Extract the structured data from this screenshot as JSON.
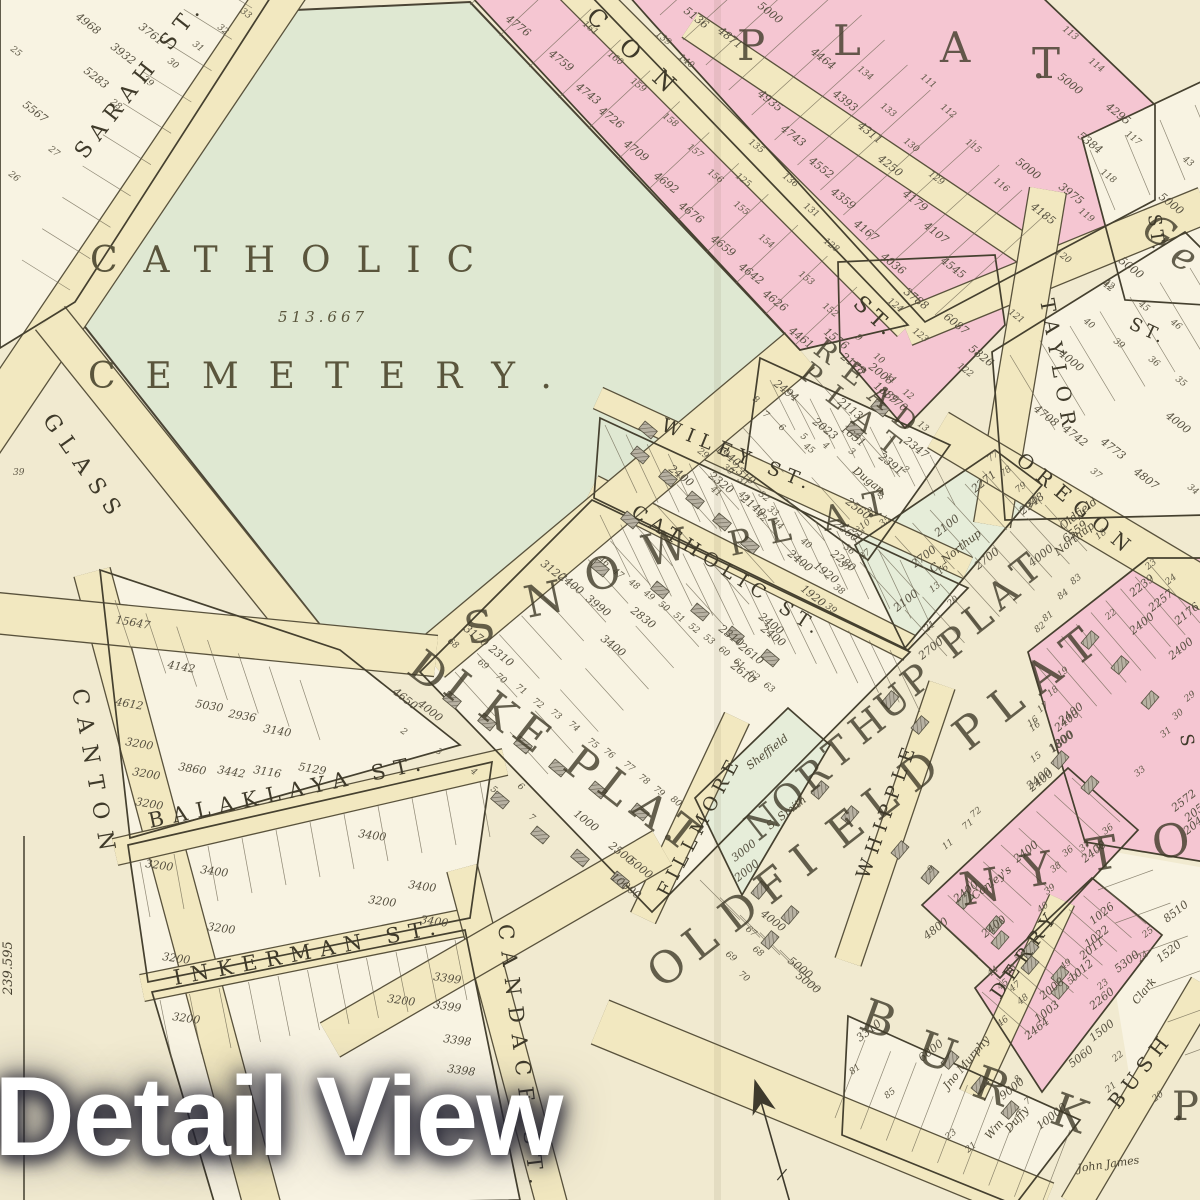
{
  "watermark": {
    "text": "Detail View"
  },
  "cemetery": {
    "name_line1": "CATHOLIC",
    "name_line2": "CEMETERY.",
    "area": "513.667"
  },
  "margin": {
    "left_number": "239.595"
  },
  "palette": {
    "paper": "#f1ead0",
    "lot_white": "#f8f3e2",
    "road": "#f2e8c0",
    "pink": "#f5c6d2",
    "green_cemetery": "#dfe8d2",
    "green_tint": "#e6edd9",
    "line": "#45402f",
    "text": "#4a4433",
    "watermark_text": "#ffffff"
  },
  "icons": [
    {
      "id": "north-arrow-icon",
      "meaning": "compass north arrow"
    }
  ],
  "streets": [
    {
      "id": "sarah",
      "label": "SARAH ST."
    },
    {
      "id": "glass",
      "label": "GLASS"
    },
    {
      "id": "canton",
      "label": "CANTON"
    },
    {
      "id": "balaklaya",
      "label": "BALAKLAYA ST."
    },
    {
      "id": "inkerman",
      "label": "INKERMAN ST."
    },
    {
      "id": "candace",
      "label": "CANDACE ST."
    },
    {
      "id": "wiley",
      "label": "WILEY ST."
    },
    {
      "id": "catholic",
      "label": "CATHOLIC ST."
    },
    {
      "id": "fillmore",
      "label": "FILLMORE"
    },
    {
      "id": "whipple",
      "label": "WHIPPLE"
    },
    {
      "id": "derry",
      "label": "DERRY"
    },
    {
      "id": "bush",
      "label": "BUSH"
    },
    {
      "id": "taylor",
      "label": "TAYLOR"
    },
    {
      "id": "taylor-st",
      "label": "ST."
    },
    {
      "id": "oregon",
      "label": "OREGON"
    },
    {
      "id": "con",
      "label": "CON"
    },
    {
      "id": "con-st",
      "label": "ST."
    },
    {
      "id": "right-edge-st",
      "label": "ST."
    },
    {
      "id": "right-edge-s",
      "label": "S"
    }
  ],
  "plats": [
    {
      "id": "plat-top",
      "label": "PLAT."
    },
    {
      "id": "read",
      "label": "READ"
    },
    {
      "id": "read-plat",
      "label": "PLAT"
    },
    {
      "id": "snow",
      "label": "SNOW"
    },
    {
      "id": "snow-plat",
      "label": "PLAT."
    },
    {
      "id": "dike",
      "label": "DIKE"
    },
    {
      "id": "dike-plat",
      "label": "PLAT."
    },
    {
      "id": "northup",
      "label": "NORTHUP PLAT"
    },
    {
      "id": "oldfield",
      "label": "OLDFIELD PLAT"
    },
    {
      "id": "letter-n",
      "label": "N"
    },
    {
      "id": "letter-y",
      "label": "Y"
    },
    {
      "id": "letter-t",
      "label": "T"
    },
    {
      "id": "letter-o",
      "label": "O"
    },
    {
      "id": "burk",
      "label": "BURK"
    },
    {
      "id": "ge",
      "label": "Ge"
    },
    {
      "id": "big-p",
      "label": "P."
    }
  ],
  "owners": [
    {
      "id": "dugan",
      "name": "Dugan"
    },
    {
      "id": "sheffield",
      "name": "Sheffield"
    },
    {
      "id": "s-smith",
      "name": "S. Smith"
    },
    {
      "id": "oldfield-owner",
      "name": "Oldfield"
    },
    {
      "id": "oldfield-no",
      "name": "6559"
    },
    {
      "id": "northup-owner",
      "name": "Northup"
    },
    {
      "id": "c-northup",
      "name": "C. Northup"
    },
    {
      "id": "conleys",
      "name": "Conley's"
    },
    {
      "id": "clark",
      "name": "Clark"
    },
    {
      "id": "jno-murphy",
      "name": "Jno Murphy"
    },
    {
      "id": "wm",
      "name": "Wm"
    },
    {
      "id": "duffy",
      "name": "Duffy"
    },
    {
      "id": "john-james",
      "name": "John James"
    }
  ],
  "blocks": [
    {
      "id": "sarah-block",
      "values": [
        "4968",
        "3761",
        "3932",
        "5283",
        "5567"
      ],
      "lot_numbers": [
        "25",
        "26",
        "27",
        "28",
        "29",
        "30",
        "31",
        "32",
        "33"
      ]
    },
    {
      "id": "con-row",
      "values": [
        "4776",
        "4759",
        "4743",
        "4726",
        "4709",
        "4692",
        "4676",
        "4659",
        "4642",
        "4626",
        "4461"
      ],
      "lot_numbers": [
        "161",
        "160",
        "159",
        "158",
        "157",
        "156",
        "155",
        "154",
        "153",
        "152"
      ]
    },
    {
      "id": "top-mid",
      "values": [
        "5136",
        "4871",
        "5000",
        "4464",
        "4935",
        "4393",
        "4743",
        "4311",
        "4552",
        "4250",
        "4359",
        "4179",
        "4167",
        "4107",
        "4036",
        "4545",
        "3788",
        "6087",
        "5826"
      ],
      "lot_numbers": [
        "139",
        "140",
        "125",
        "128",
        "129",
        "130",
        "131",
        "133",
        "134",
        "135",
        "136",
        "124",
        "123",
        "122",
        "121"
      ]
    },
    {
      "id": "t-block",
      "values": [
        "5000",
        "4295",
        "5384",
        "3975",
        "4185",
        "5000"
      ],
      "lot_numbers": [
        "111",
        "112",
        "113",
        "114",
        "115",
        "116",
        "117",
        "118",
        "119",
        "120"
      ]
    },
    {
      "id": "taylor-block",
      "values": [
        "4000",
        "4708",
        "4742",
        "4773",
        "4807",
        "4000"
      ],
      "lot_numbers": [
        "34",
        "35",
        "36",
        "37",
        "39",
        "40",
        "42",
        "45",
        "46"
      ]
    },
    {
      "id": "ge-block",
      "values": [
        "5000",
        "5000"
      ],
      "lot_numbers": [
        "43",
        "42"
      ]
    },
    {
      "id": "read-plat-block",
      "values": [
        "2494",
        "1576",
        "2178",
        "2113",
        "2008",
        "1889",
        "1770",
        "2023",
        "1651",
        "2347",
        "2391"
      ],
      "lot_numbers": [
        "2",
        "3",
        "4",
        "5",
        "6",
        "7",
        "8",
        "9",
        "10",
        "11",
        "12",
        "13"
      ]
    },
    {
      "id": "snow-plat-block",
      "values": [
        "2400",
        "1940",
        "2310",
        "2320",
        "2560",
        "2560",
        "2280",
        "2400",
        "1920",
        "1920",
        "2400",
        "2140"
      ],
      "lot_numbers": [
        "29",
        "30",
        "31",
        "32",
        "33",
        "35",
        "36",
        "37",
        "38",
        "39",
        "40",
        "41",
        "42",
        "43",
        "44",
        "45"
      ]
    },
    {
      "id": "catholic-row",
      "values": [
        "2400",
        "2610",
        "2610",
        "2310",
        "3120",
        "2400",
        "3400",
        "2830",
        "3990"
      ],
      "lot_numbers": [
        "46",
        "47",
        "48",
        "49",
        "50",
        "51",
        "52",
        "53",
        "60",
        "61",
        "62",
        "63"
      ]
    },
    {
      "id": "dike-block",
      "values": [
        "4650",
        "4000",
        "3170",
        "2310",
        "1000",
        "2500",
        "5000",
        "10000"
      ],
      "lot_numbers": [
        "68",
        "69",
        "70",
        "71",
        "72",
        "73",
        "74",
        "75",
        "76",
        "77",
        "78",
        "79",
        "80",
        "2",
        "3",
        "4",
        "5",
        "6",
        "7"
      ]
    },
    {
      "id": "fillmore-block",
      "values": [
        "5000",
        "5000",
        "4000"
      ],
      "lot_numbers": [
        "67",
        "68",
        "69",
        "70"
      ]
    },
    {
      "id": "northup-block",
      "values": [
        "2271",
        "2100",
        "2948",
        "2700",
        "2700",
        "2100",
        "2700",
        "4000",
        "3000",
        "2000"
      ],
      "lot_numbers": [
        "8",
        "9",
        "10",
        "11",
        "13",
        "16",
        "18",
        "20",
        "21",
        "35",
        "37",
        "77",
        "78",
        "79",
        "80",
        "81",
        "82",
        "83",
        "84"
      ]
    },
    {
      "id": "conley-block",
      "values": [
        "2400",
        "1800",
        "2400",
        "2400",
        "4800",
        "2400",
        "2400"
      ],
      "lot_numbers": [
        "9",
        "11",
        "15",
        "16",
        "36",
        "37",
        "38",
        "39",
        "40",
        "71",
        "72"
      ]
    },
    {
      "id": "derry-block",
      "values": [
        "1026",
        "1022",
        "2011",
        "1012",
        "2008",
        "1003",
        "2464",
        "2400"
      ],
      "lot_numbers": [
        "42",
        "43",
        "44",
        "45",
        "46",
        "47",
        "48",
        "49",
        "50"
      ]
    },
    {
      "id": "bush-block",
      "values": [
        "8510",
        "1520",
        "5300",
        "2260",
        "1500",
        "5060",
        "2572",
        "2050",
        "2045"
      ],
      "lot_numbers": [
        "20",
        "21",
        "22",
        "23",
        "24",
        "25"
      ]
    },
    {
      "id": "burk-block",
      "values": [
        "9000",
        "10000",
        "6000",
        "3310"
      ],
      "lot_numbers": [
        "7",
        "8",
        "85",
        "23",
        "21",
        "81"
      ]
    },
    {
      "id": "right-column",
      "values": [
        "2239",
        "2257",
        "2176",
        "2400",
        "2400",
        "2400",
        "1800",
        "2400"
      ],
      "lot_numbers": [
        "16",
        "17",
        "18",
        "19",
        "22",
        "23",
        "24",
        "29",
        "30",
        "31",
        "33",
        "36",
        "37"
      ]
    },
    {
      "id": "canton-block",
      "values": [
        "15647",
        "4142",
        "4612",
        "5030",
        "2936",
        "3140",
        "5129",
        "3200",
        "3200",
        "3200",
        "3860",
        "3442",
        "3116"
      ],
      "lot_numbers": [
        "39"
      ]
    },
    {
      "id": "balaklaya-block",
      "values": [
        "3200",
        "3400",
        "3200",
        "3400",
        "3400",
        "3200",
        "3200"
      ],
      "lot_numbers": []
    },
    {
      "id": "inkerman-block",
      "values": [
        "3200",
        "3200",
        "3399",
        "3399",
        "3398",
        "3398",
        "3400"
      ],
      "lot_numbers": []
    }
  ]
}
